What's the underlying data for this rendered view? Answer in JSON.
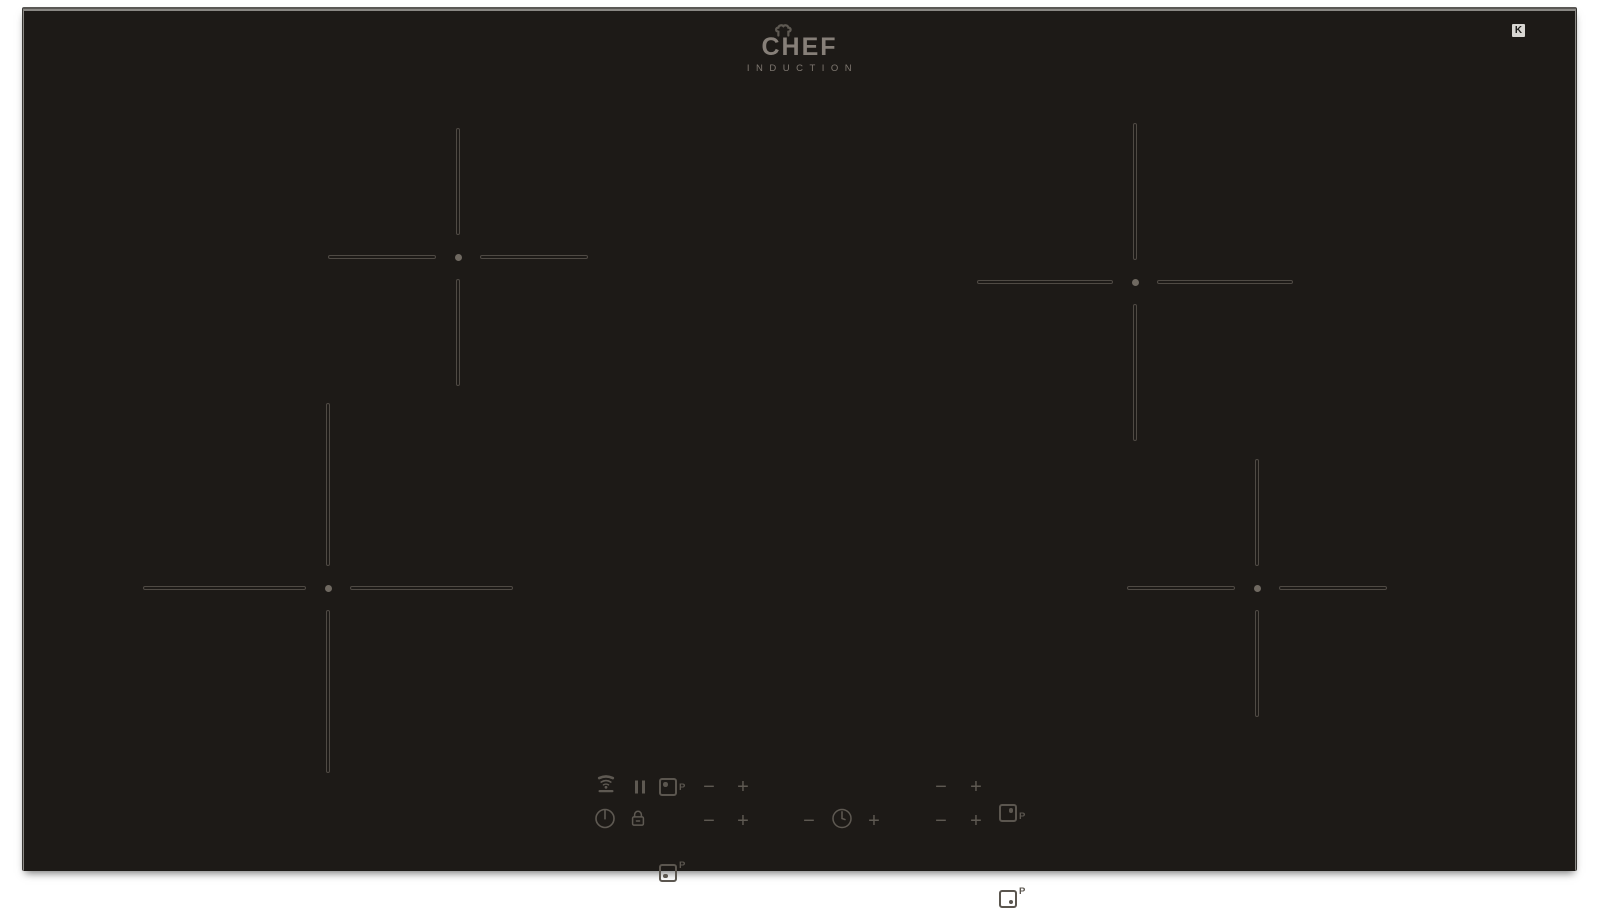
{
  "brand": {
    "name": "CHEF",
    "tagline": "INDUCTION"
  },
  "corner_badge": {
    "glyph": "K"
  },
  "controls": {
    "minus_label": "−",
    "plus_label": "+",
    "zone_selectors": [
      {
        "zone": "rear-left",
        "boost_label": "P"
      },
      {
        "zone": "rear-right",
        "boost_label": "P"
      },
      {
        "zone": "front-left",
        "boost_label": "P"
      },
      {
        "zone": "front-right",
        "boost_label": "P"
      }
    ],
    "icons": {
      "hob2hood": "hob2hood-icon",
      "pause": "pause-icon",
      "power": "power-icon",
      "lock": "lock-icon",
      "timer": "timer-clock-icon"
    }
  },
  "colors": {
    "surface": "#1d1a17",
    "marking": "#4f4a44",
    "control": "#5e5952",
    "logo": "#867f78",
    "badge_bg": "#d8d6d2"
  }
}
